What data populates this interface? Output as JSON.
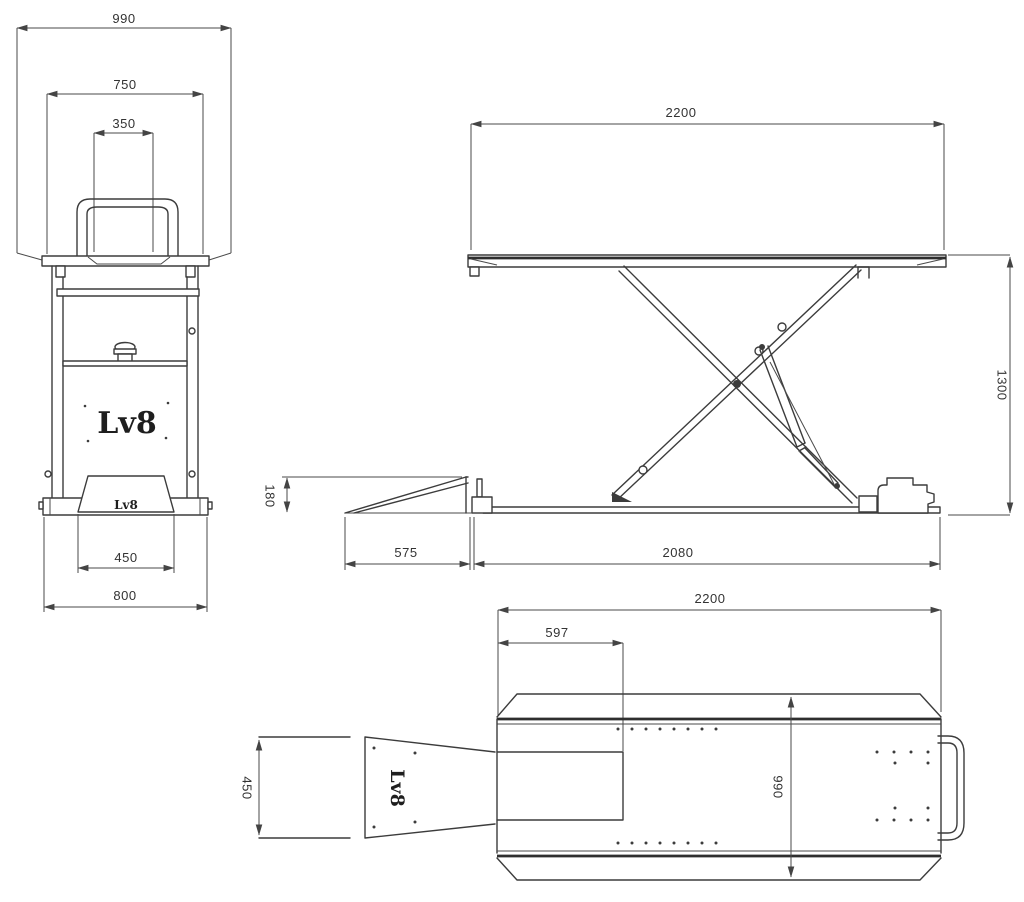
{
  "drawing": {
    "brand_logo": "Lv8",
    "front_view": {
      "overall_width": "990",
      "platform_width": "750",
      "handle_width": "350",
      "ramp_width": "450",
      "base_width": "800"
    },
    "side_view": {
      "platform_length": "2200",
      "lift_height": "1300",
      "ramp_height": "180",
      "ramp_length": "575",
      "base_length": "2080"
    },
    "top_view": {
      "platform_length": "2200",
      "cutout_offset": "597",
      "ramp_width": "450",
      "platform_width": "990"
    }
  }
}
